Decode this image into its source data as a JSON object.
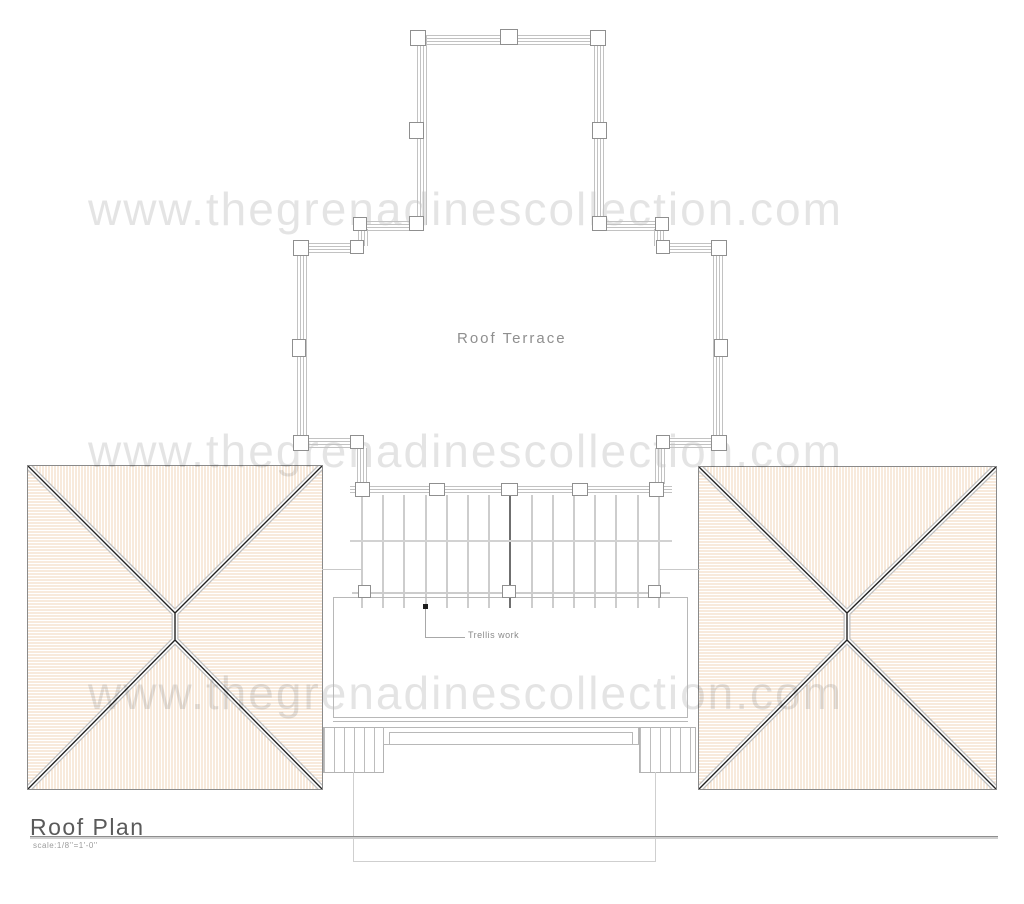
{
  "watermark": {
    "text": "www.thegrenadinescollection.com",
    "color": "#e3e3e3",
    "rows": 3
  },
  "terrace": {
    "label": "Roof Terrace"
  },
  "trellis": {
    "label": "Trellis work",
    "bar_count": 15,
    "center_bar_index": 7,
    "bar_spacing_px": 21.2
  },
  "title_block": {
    "title": "Roof Plan",
    "scale": "scale:1/8''=1'-0''"
  },
  "colors": {
    "roof_hatch": "#f0d5ba",
    "rail_line": "#c2c2c2",
    "diagonal_line": "#222222",
    "outline_light": "#c9c9c9",
    "watermark_gray": "#e3e3e3"
  }
}
